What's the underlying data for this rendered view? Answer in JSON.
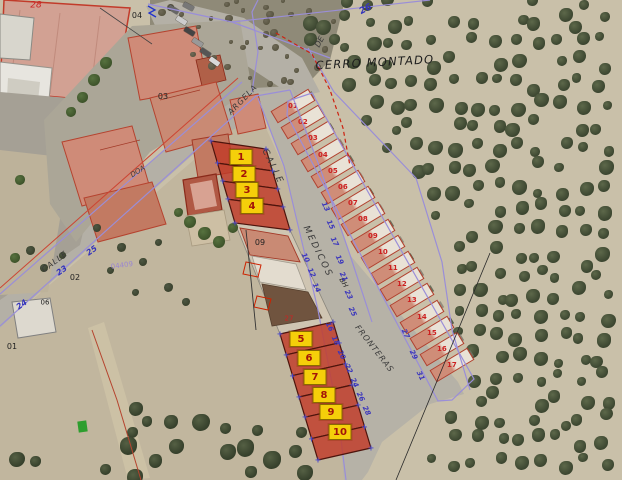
{
  "map": {
    "area_name": {
      "text": "CERRO MONTADO",
      "x": 375,
      "y": 63,
      "rot": -3,
      "fs": 11.5,
      "ls": 1.2
    },
    "street_labels": [
      {
        "text": "CALLE",
        "x": 272,
        "y": 167,
        "rot": 64,
        "fs": 9,
        "ls": 2,
        "color": "#3a3a3a"
      },
      {
        "text": "MEDICOS",
        "x": 317,
        "y": 252,
        "rot": 64,
        "fs": 9,
        "ls": 2,
        "color": "#3a3a3a"
      },
      {
        "text": "FRONTERAS",
        "x": 374,
        "y": 349,
        "rot": 52,
        "fs": 8,
        "ls": 1,
        "color": "#3a3a3a"
      },
      {
        "text": "CALLE",
        "x": 55,
        "y": 262,
        "rot": -37,
        "fs": 8,
        "ls": 1,
        "color": "#3a3a3a"
      },
      {
        "text": "ARGELA",
        "x": 243,
        "y": 100,
        "rot": -46,
        "fs": 8,
        "ls": 1,
        "color": "#3a3a3a"
      },
      {
        "text": "DOA",
        "x": 138,
        "y": 172,
        "rot": -33,
        "fs": 7,
        "ls": 0,
        "color": "#3a3a3a"
      },
      {
        "text": "DE",
        "x": 320,
        "y": 42,
        "rot": -62,
        "fs": 8,
        "ls": 0,
        "color": "#3a3a3a"
      },
      {
        "text": "BH",
        "x": 343,
        "y": 283,
        "rot": 60,
        "fs": 7,
        "ls": 0,
        "color": "#2a2a2a"
      }
    ],
    "parcel_labels": [
      {
        "text": "04",
        "x": 137,
        "y": 16,
        "color": "#222222",
        "fs": 8
      },
      {
        "text": "03",
        "x": 163,
        "y": 97,
        "color": "#222222",
        "fs": 8
      },
      {
        "text": "02",
        "x": 75,
        "y": 278,
        "color": "#222222",
        "fs": 8
      },
      {
        "text": "06",
        "x": 45,
        "y": 303,
        "color": "#222222",
        "fs": 7
      },
      {
        "text": "09",
        "x": 260,
        "y": 243,
        "color": "#222222",
        "fs": 8
      },
      {
        "text": "01",
        "x": 12,
        "y": 347,
        "color": "#222222",
        "fs": 8
      },
      {
        "text": "28",
        "x": 36,
        "y": 6,
        "color": "#cc2222",
        "fs": 9,
        "italic": true
      },
      {
        "text": "27",
        "x": 289,
        "y": 319,
        "color": "#cc2222",
        "fs": 7
      },
      {
        "text": "26",
        "x": 366,
        "y": 10,
        "color": "#3333bb",
        "fs": 9,
        "rot": -28,
        "italic": true,
        "bold": true
      },
      {
        "text": "25",
        "x": 92,
        "y": 251,
        "color": "#3333bb",
        "fs": 8,
        "rot": -35,
        "italic": true,
        "bold": true
      },
      {
        "text": "23",
        "x": 62,
        "y": 271,
        "color": "#3333bb",
        "fs": 8,
        "rot": -35,
        "italic": true,
        "bold": true
      },
      {
        "text": "24",
        "x": 22,
        "y": 305,
        "color": "#3333bb",
        "fs": 8,
        "rot": -35,
        "italic": true,
        "bold": true
      },
      {
        "text": "04409",
        "x": 122,
        "y": 266,
        "color": "#9b87d0",
        "fs": 7,
        "rot": -8
      }
    ],
    "street_number_runs": [
      {
        "values": [
          "10",
          "12",
          "14"
        ],
        "x": 305,
        "y": 258,
        "dx": 5.5,
        "dy": 15,
        "rot": 64
      },
      {
        "values": [
          "13",
          "15",
          "17",
          "19",
          "21",
          "23",
          "25"
        ],
        "x": 325,
        "y": 207,
        "dx": 4.5,
        "dy": 17.5,
        "rot": 64
      },
      {
        "values": [
          "16",
          "18",
          "20",
          "22",
          "24",
          "26",
          "28"
        ],
        "x": 329,
        "y": 327,
        "dx": 6.2,
        "dy": 14,
        "rot": 64
      },
      {
        "values": [
          "27",
          "29",
          "31"
        ],
        "x": 405,
        "y": 334,
        "dx": 7.5,
        "dy": 21,
        "rot": 64
      }
    ],
    "plot_badges": [
      {
        "label": "1",
        "x": 241,
        "y": 157
      },
      {
        "label": "2",
        "x": 244,
        "y": 174
      },
      {
        "label": "3",
        "x": 247,
        "y": 190
      },
      {
        "label": "4",
        "x": 252,
        "y": 206
      },
      {
        "label": "5",
        "x": 301,
        "y": 339
      },
      {
        "label": "6",
        "x": 309,
        "y": 358
      },
      {
        "label": "7",
        "x": 315,
        "y": 377
      },
      {
        "label": "8",
        "x": 324,
        "y": 395
      },
      {
        "label": "9",
        "x": 331,
        "y": 412
      },
      {
        "label": "10",
        "x": 340,
        "y": 432
      }
    ],
    "townhouse_numbers": [
      "01",
      "02",
      "03",
      "04",
      "05",
      "06",
      "07",
      "08",
      "09",
      "10",
      "11",
      "12",
      "13",
      "14",
      "15",
      "16",
      "17"
    ],
    "colors": {
      "plot_fill": "#c13a28",
      "plot_border": "#4d140c",
      "badge_bg": "#f5cf0a",
      "badge_text": "#a31409",
      "cadastral_purple": "#9a8ed8",
      "cadastral_red": "#cc4433",
      "street_number_blue": "#3a35bd",
      "olive_field": "#c9c0a9",
      "street": "#b4b0a6",
      "green_marker": "#2e9e2e"
    }
  }
}
